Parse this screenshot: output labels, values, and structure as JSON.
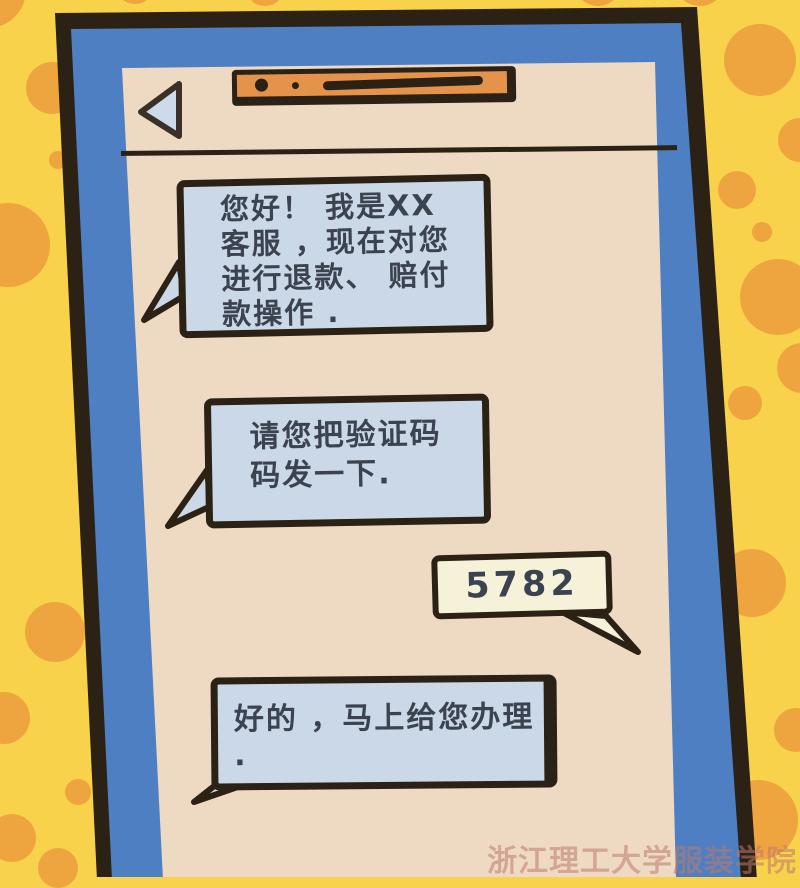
{
  "scene": {
    "description_labels": {},
    "colors": {
      "background_yellow": "#f9d24b",
      "background_spot_orange": "#efa53f",
      "phone_bezel_blue": "#4d7fc2",
      "ink_outline": "#2b2114",
      "screen_tan": "#eed9c3",
      "bubble_blue": "#cbd8e7",
      "bubble_cream": "#f6f2da",
      "speaker_bar_orange": "#e5934a",
      "text_dark": "#3c4350"
    }
  },
  "header": {
    "back_icon": "back-arrow-left-triangle",
    "camera_icon": "camera-dot",
    "speaker_icon": "speaker-slit"
  },
  "messages": [
    {
      "sender": "contact",
      "bubble": "blue",
      "lines": [
        "您好！ 我是XX",
        "客服 ，现在对您",
        "进行退款、 赔付",
        "款操作 ."
      ]
    },
    {
      "sender": "contact",
      "bubble": "blue",
      "lines": [
        "请您把验证码",
        "码发一下."
      ]
    },
    {
      "sender": "user",
      "bubble": "cream",
      "lines": [
        "5782"
      ]
    },
    {
      "sender": "contact",
      "bubble": "blue",
      "lines": [
        "好的 ，马上给您办理 ."
      ]
    }
  ],
  "watermark": {
    "text": "浙江理工大学服装学院"
  }
}
